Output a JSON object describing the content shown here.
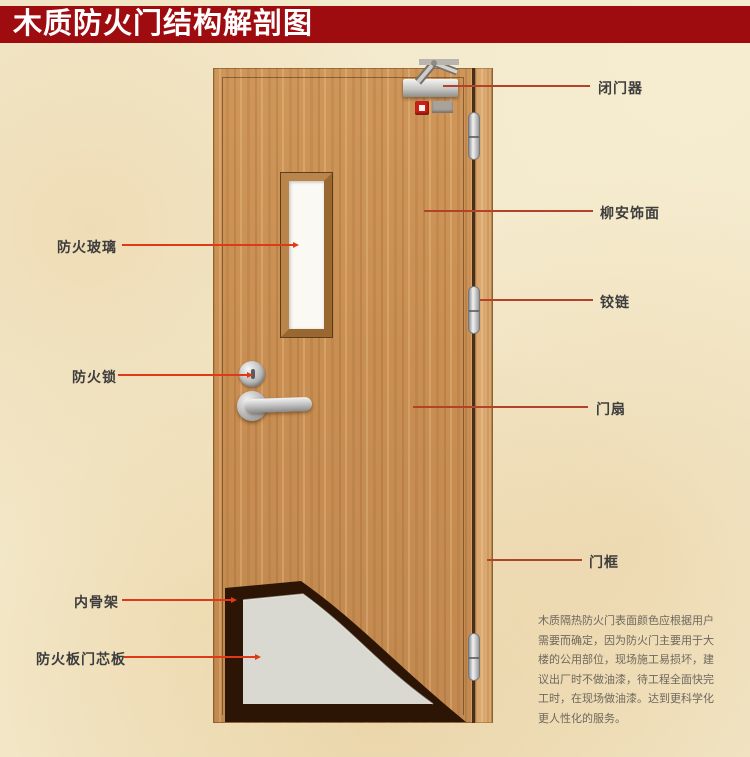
{
  "title": "木质防火门结构解剖图",
  "door": {
    "parts_right": [
      {
        "id": "door-closer",
        "label": "闭门器"
      },
      {
        "id": "lauan-veneer",
        "label": "柳安饰面"
      },
      {
        "id": "hinge",
        "label": "铰链"
      },
      {
        "id": "door-leaf",
        "label": "门扇"
      },
      {
        "id": "door-frame",
        "label": "门框"
      }
    ],
    "parts_left": [
      {
        "id": "fire-glass",
        "label": "防火玻璃"
      },
      {
        "id": "fire-lock",
        "label": "防火锁"
      },
      {
        "id": "inner-skeleton",
        "label": "内骨架"
      },
      {
        "id": "fire-board-core",
        "label": "防火板门芯板"
      }
    ]
  },
  "description": {
    "lines": [
      "木质隔热防火门表面颜色应根据用户",
      "需要而确定，因为防火门主要用于大",
      "楼的公用部位，现场施工易损坏，建",
      "议出厂时不做油漆，待工程全面快完",
      "工时，在现场做油漆。达到更科学化",
      "更人性化的服务。"
    ]
  },
  "colors": {
    "banner": "#9e0c10",
    "background": "#f3e9cc",
    "wood": "#c88f54",
    "frame_wood": "#daa76e",
    "leader_left": "#df3a17",
    "leader_right": "#b2432a",
    "core_grey": "#d9d9d2",
    "skeleton_dark": "#2c1505"
  }
}
